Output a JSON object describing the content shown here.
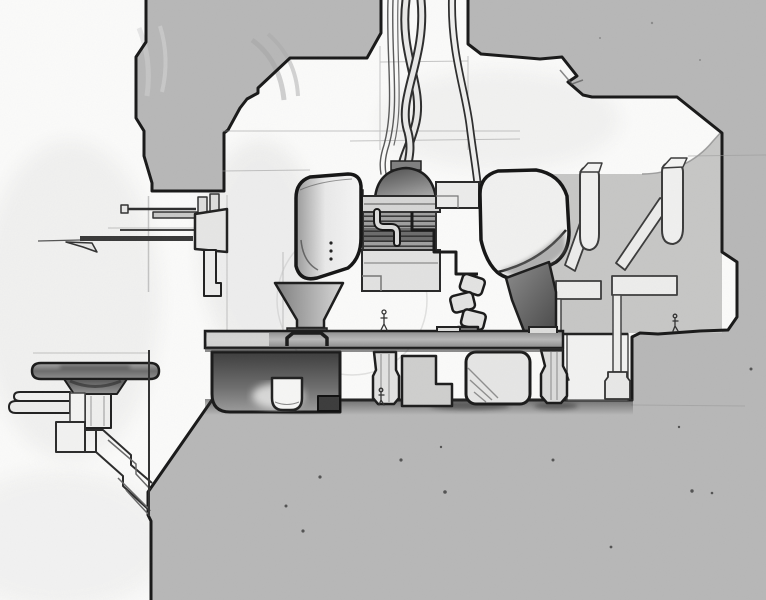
{
  "artwork": {
    "title": "Graphite concept sketch — suspended machine in a cutaway chamber",
    "medium": "pencil on paper",
    "scene": "Cross-section concept drawing: a rounded twin-pod machine hangs in a rectangular chamber cut into grey masses. Twisted cables drop through a ceiling shaft into a domed manifold. The machine stands on flared legs over a horizontal service beam; an antenna boom extends left, a mushroom-shaped dish platform is cantilevered at lower left, hanger posts and braces line the right wall, and tiny human figures give scale.",
    "palette": {
      "paper": "#fbfbfa",
      "mass_grey": "#b8b8b8",
      "interior_wall_grey": "#c7c7c6",
      "line_heavy": "#181818",
      "line_medium": "#3c3c3c",
      "line_light": "#9a9a9a",
      "shading_dark": "#4a4a4a",
      "machine_highlight": "#f4f4f3",
      "beam_grey": "#aFaFaF"
    },
    "scale_figure_count": 3,
    "components": [
      {
        "id": "ceiling-mass-left",
        "label": "Stepped upper-left mass"
      },
      {
        "id": "ceiling-mass-right",
        "label": "Upper-right mass, right wall and foreground ledge"
      },
      {
        "id": "cable-shaft",
        "label": "White ceiling shaft between the masses"
      },
      {
        "id": "cable-bundle",
        "label": "Twisted supply cables"
      },
      {
        "id": "intake-dome",
        "label": "Domed cable manifold"
      },
      {
        "id": "left-pod",
        "label": "Left rounded equipment pod with rivets"
      },
      {
        "id": "right-pod",
        "label": "Right rounded equipment pod"
      },
      {
        "id": "center-housing",
        "label": "Central striped housing with S-duct"
      },
      {
        "id": "service-beam",
        "label": "Horizontal service platform beam with railing"
      },
      {
        "id": "support-structure",
        "label": "Under-beam boxes, legs and footing pads"
      },
      {
        "id": "elbow-duct",
        "label": "Articulated elbow duct"
      },
      {
        "id": "antenna-boom",
        "label": "Antenna boom assembly with pennant"
      },
      {
        "id": "dish-platform",
        "label": "Cantilevered mushroom platform with stepped brackets"
      },
      {
        "id": "wall-hangers",
        "label": "Right-wall hanger posts, diagonal braces, beams and drop rods"
      },
      {
        "id": "scale-figures",
        "label": "Tiny human figures for scale"
      },
      {
        "id": "ground-specks",
        "label": "Graphite specks on the foreground ledge"
      }
    ]
  }
}
